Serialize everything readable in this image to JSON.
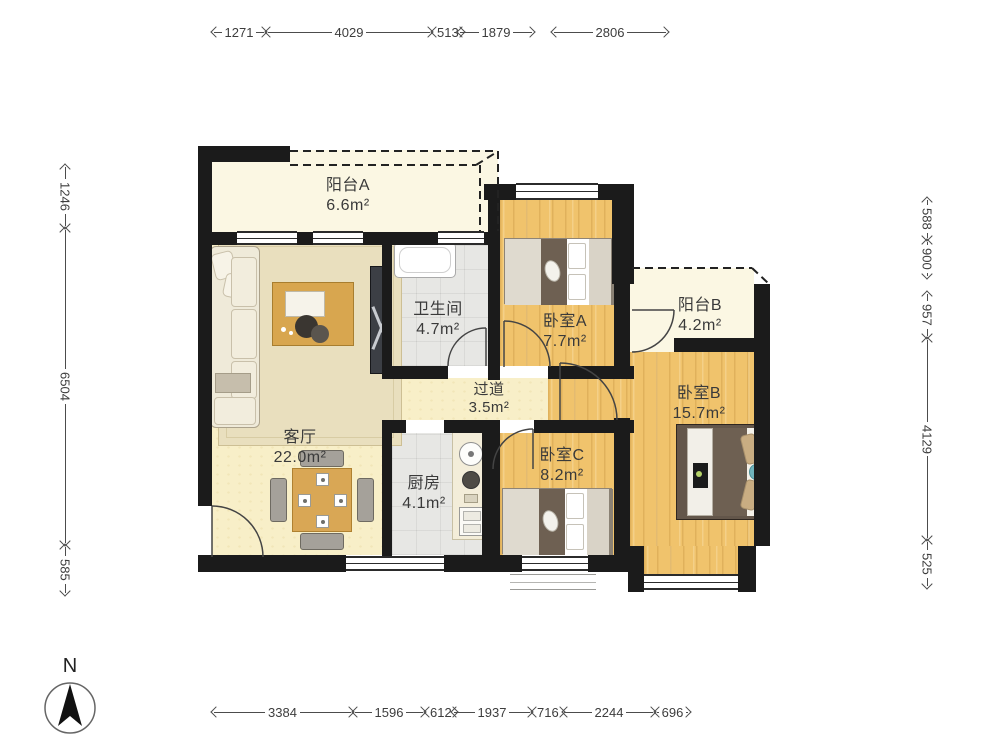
{
  "plan_title": "apartment-floor-plan",
  "compass": {
    "label": "N"
  },
  "rooms": {
    "balcony_a": {
      "name": "阳台A",
      "area": "6.6m²"
    },
    "living": {
      "name": "客厅",
      "area": "22.0m²"
    },
    "bathroom": {
      "name": "卫生间",
      "area": "4.7m²"
    },
    "bedroom_a": {
      "name": "卧室A",
      "area": "7.7m²"
    },
    "balcony_b": {
      "name": "阳台B",
      "area": "4.2m²"
    },
    "bedroom_b": {
      "name": "卧室B",
      "area": "15.7m²"
    },
    "hallway": {
      "name": "过道",
      "area": "3.5m²"
    },
    "kitchen": {
      "name": "厨房",
      "area": "4.1m²"
    },
    "bedroom_c": {
      "name": "卧室C",
      "area": "8.2m²"
    }
  },
  "dimensions": {
    "top": [
      "1271",
      "4029",
      "513",
      "1879",
      "2806"
    ],
    "bottom": [
      "3384",
      "1596",
      "612",
      "1937",
      "716",
      "2244",
      "696"
    ],
    "left": [
      "1246",
      "6504",
      "585"
    ],
    "right": [
      "588",
      "900",
      "957",
      "4129",
      "525"
    ]
  },
  "colors": {
    "wall": "#1B1B1B",
    "wood_floor": "#F0C36C",
    "living_floor": "#F8EFC8",
    "balcony_floor": "#FBF7E3",
    "tile_floor": "#E7E7E4",
    "rug": "#E9DFBE",
    "duvet_brown": "#6E6052",
    "accent_teal": "#6FB3BB",
    "dimension_text": "#3D3D3D"
  }
}
